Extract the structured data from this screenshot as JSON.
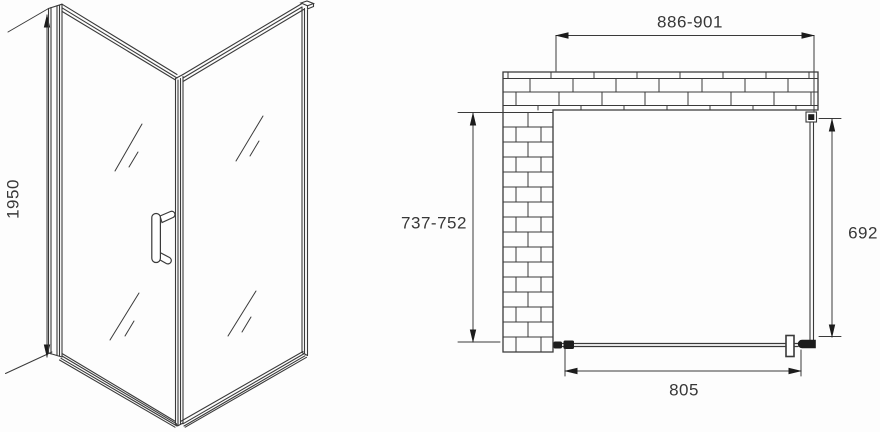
{
  "drawing": {
    "description": "Corner shower enclosure technical drawing: perspective view and plan view with dimensions",
    "colors": {
      "line": "#3a3a3a",
      "background": "#fdfdfd",
      "hardware_fill": "#1c1c1c"
    },
    "labels": {
      "height": "1950",
      "width_range": "886-901",
      "depth_range": "737-752",
      "side_panel": "692",
      "door_width": "805"
    }
  }
}
